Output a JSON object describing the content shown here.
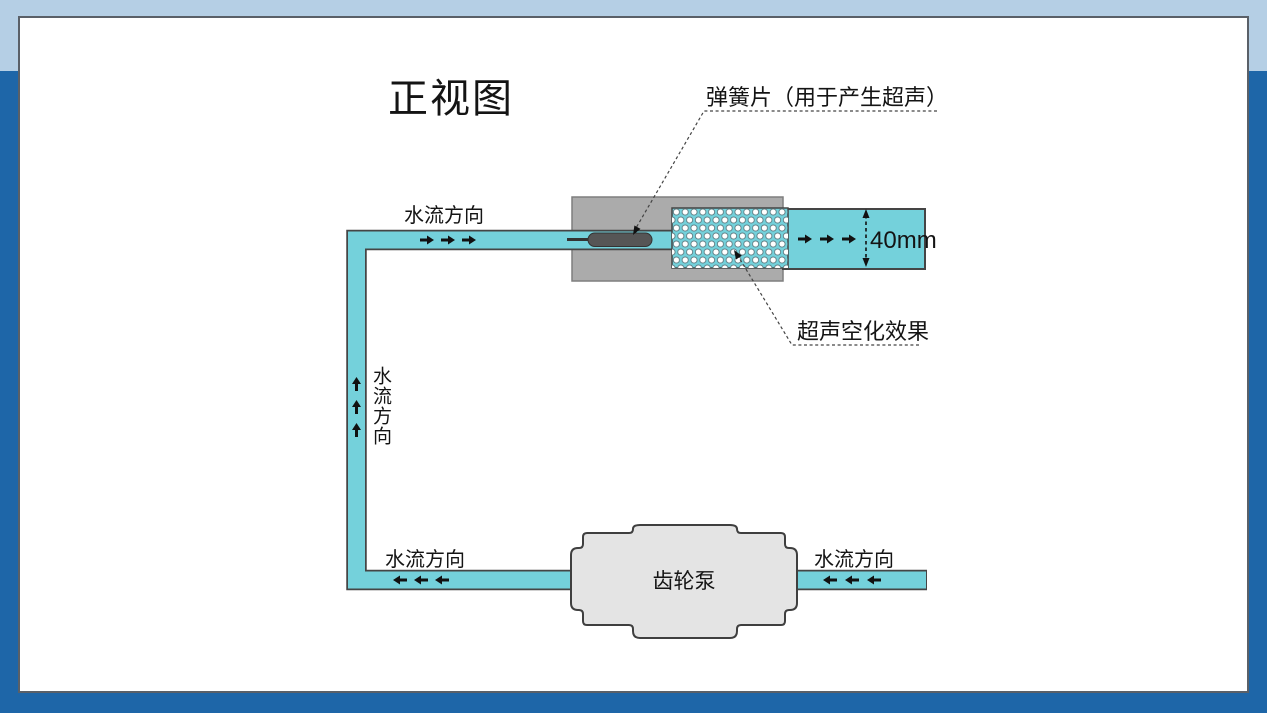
{
  "page": {
    "top_band_color": "#b5cfe5",
    "background_color": "#1e66a8",
    "panel_color": "#ffffff"
  },
  "diagram": {
    "title": "正视图",
    "spring_label": "弹簧片（用于产生超声）",
    "cavitation_label": "超声空化效果",
    "dimension_label": "40mm",
    "pump_label": "齿轮泵",
    "flow_label_top": "水流方向",
    "flow_label_vertical": "水流方向",
    "flow_label_bottom_left": "水流方向",
    "flow_label_bottom_right": "水流方向",
    "colors": {
      "pipe": "#74d1db",
      "housing_block": "#ababab",
      "spring_plate": "#565656",
      "pump_body": "#e4e4e4",
      "outline": "#454545",
      "bubbles": "#ffffff",
      "arrow": "#111111"
    }
  }
}
